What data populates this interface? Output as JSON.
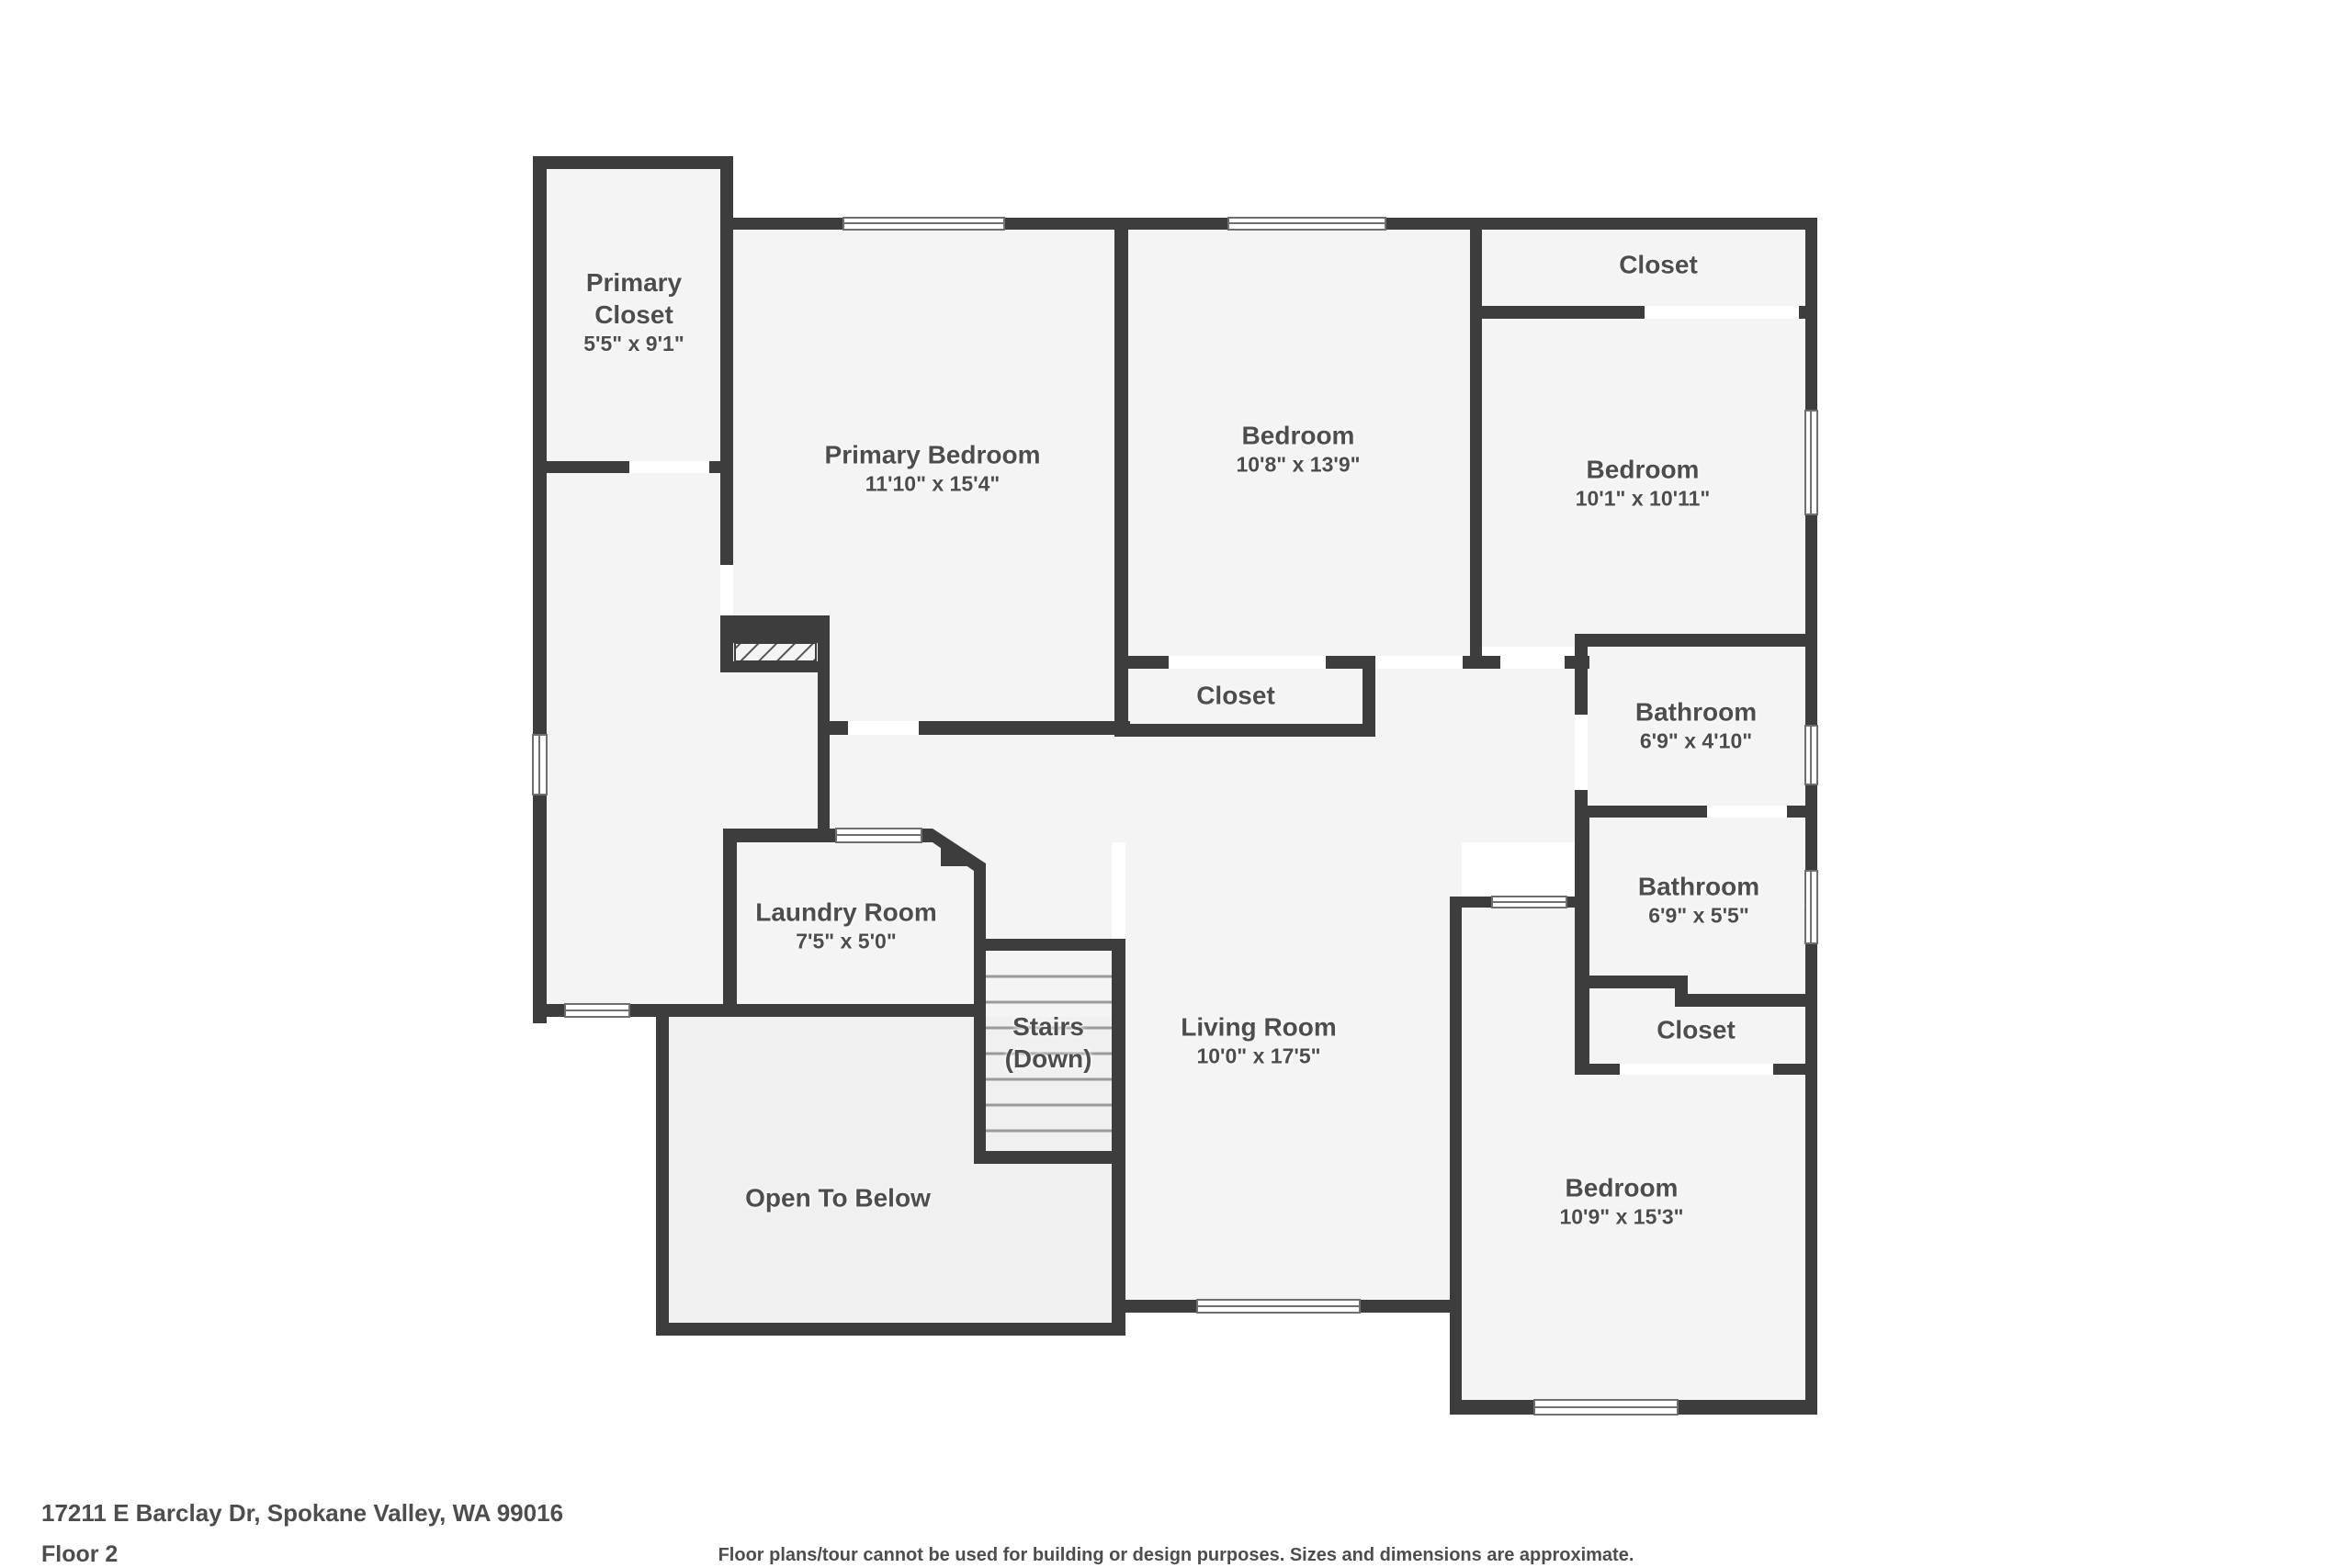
{
  "colors": {
    "wall": "#3d3d3d",
    "room": "#f4f4f4",
    "open": "#f0f0f0",
    "ink": "#4d4d4d"
  },
  "rooms": [
    {
      "name": "Primary Closet",
      "dims": "5'5\" x 9'1\""
    },
    {
      "name": "Primary Bedroom",
      "dims": "11'10\" x 15'4\""
    },
    {
      "name": "Bedroom",
      "dims": "10'8\" x 13'9\""
    },
    {
      "name": "Closet"
    },
    {
      "name": "Bedroom",
      "dims": "10'1\" x 10'11\""
    },
    {
      "name": "Closet"
    },
    {
      "name": "Bathroom",
      "dims": "6'9\" x 4'10\""
    },
    {
      "name": "Bathroom",
      "dims": "6'9\" x 5'5\""
    },
    {
      "name": "Closet"
    },
    {
      "name": "Laundry Room",
      "dims": "7'5\" x 5'0\""
    },
    {
      "name": "Stairs",
      "name2": "(Down)"
    },
    {
      "name": "Living Room",
      "dims": "10'0\" x 17'5\""
    },
    {
      "name": "Open To Below"
    },
    {
      "name": "Bedroom",
      "dims": "10'9\" x 15'3\""
    }
  ],
  "footer": {
    "address": "17211 E Barclay Dr, Spokane Valley, WA 99016",
    "floor": "Floor 2",
    "disclaimer": "Floor plans/tour cannot be used for building or design purposes. Sizes and dimensions are approximate."
  }
}
